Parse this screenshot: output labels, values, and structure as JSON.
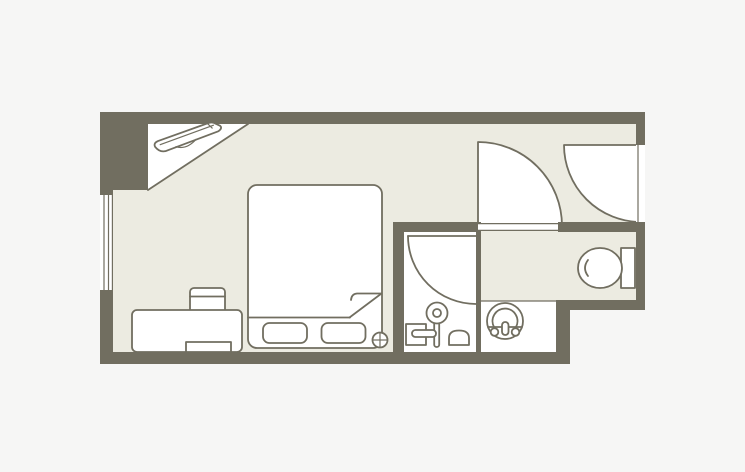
{
  "palette": {
    "background": "#f6f6f5",
    "wall": "#716e60",
    "floor": "#ecebe1",
    "white": "#ffffff",
    "line": "#716e60"
  },
  "floor_plan": {
    "type": "hotel-room-floor-plan",
    "rooms": [
      {
        "name": "main-room",
        "fixtures": [
          "double-bed",
          "pillow-left",
          "pillow-right",
          "blanket-fold",
          "desk",
          "desk-chair",
          "under-desk-stool",
          "outlet-symbol"
        ]
      },
      {
        "name": "closet",
        "fixtures": [
          "luggage-rack"
        ]
      },
      {
        "name": "entry-hall",
        "fixtures": [
          "entrance-door-swing",
          "room-door-swing"
        ]
      },
      {
        "name": "shower-room",
        "fixtures": [
          "shower-door-swing",
          "hand-shower",
          "bath-stool",
          "wash-bowl"
        ]
      },
      {
        "name": "washroom",
        "fixtures": [
          "round-washbasin"
        ]
      },
      {
        "name": "toilet-area",
        "fixtures": [
          "toilet"
        ]
      }
    ],
    "openings": [
      "window-left-wall",
      "entrance-door-right-wall",
      "room-door",
      "shower-door"
    ]
  }
}
